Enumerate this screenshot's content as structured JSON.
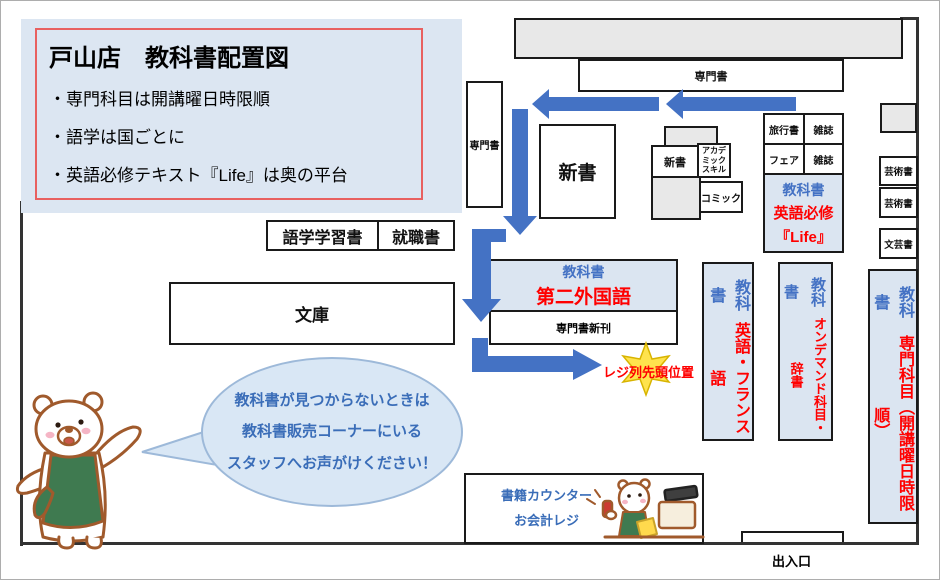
{
  "colors": {
    "accent_blue": "#4472c4",
    "text_red": "#ff0000",
    "panel_light_blue": "#dbe5f1",
    "title_border_red": "#e86060",
    "shelf_gray": "#e8e8e8",
    "bubble_text_blue": "#3a6db8",
    "star_yellow": "#ffe34d"
  },
  "title_panel": {
    "title": "戸山店　教科書配置図",
    "bullets": [
      "・専門科目は開講曜日時限順",
      "・語学は国ごとに",
      "・英語必修テキスト『Life』は奥の平台"
    ]
  },
  "shelves": {
    "senmonsho_top": "専門書",
    "senmonsho_left": "専門書",
    "shinsho_large": "新書",
    "shinsho_small": "新書",
    "academic_skill": "アカデミックスキル",
    "comic": "コミック",
    "travel": "旅行書",
    "magazine_1": "雑誌",
    "fair": "フェア",
    "magazine_2": "雑誌",
    "gogaku": "語学学習書",
    "shushoku": "就職書",
    "bunko": "文庫",
    "art_1": "芸術書",
    "art_2": "芸術書",
    "bungei": "文芸書"
  },
  "textbooks": {
    "life": {
      "heading": "教科書",
      "line1": "英語必修",
      "line2": "『Life』"
    },
    "second_foreign": {
      "heading": "教科書",
      "body": "第二外国語",
      "sub": "専門書新刊"
    },
    "english_french": {
      "heading": "教科書",
      "body": "英語・フランス語"
    },
    "on_demand": {
      "heading": "教科書",
      "body": "オンデマンド科目・辞書"
    },
    "major_subjects": {
      "heading": "教科書",
      "body": "専門科目（開講曜日時限順）"
    }
  },
  "register": {
    "queue_head_label": "レジ列先頭位置"
  },
  "counter": {
    "line1": "書籍カウンター",
    "line2": "お会計レジ"
  },
  "entrance_label": "出入口",
  "speech_bubble": {
    "lines": [
      "教科書が見つからないときは",
      "教科書販売コーナーにいる",
      "スタッフへお声がけください！"
    ]
  }
}
